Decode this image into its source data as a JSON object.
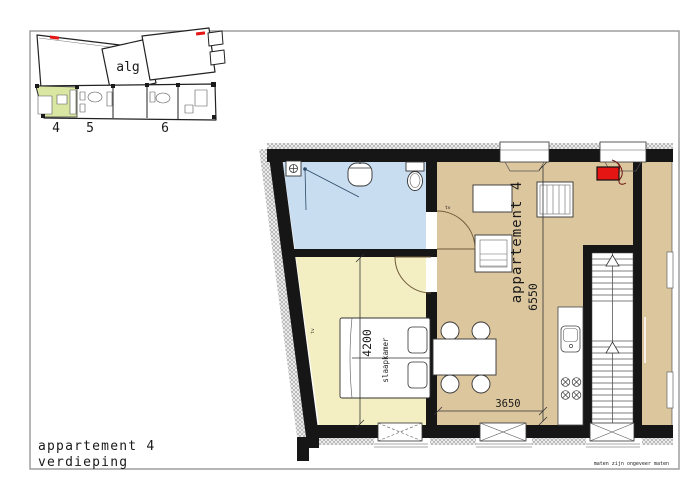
{
  "drawing": {
    "title_line1": "appartement 4",
    "title_line2": "verdieping",
    "disclaimer": "maten zijn ongeveer maten"
  },
  "overview": {
    "common_label": "alg",
    "apartments": [
      "4",
      "5",
      "6"
    ]
  },
  "plan": {
    "apartment_label": "appartement 4",
    "bedroom_label": "slaapkamer",
    "dim_living_depth": "6550",
    "dim_living_width": "3650",
    "dim_bedroom_depth": "4200",
    "tv_label_bedroom": "tv",
    "tv_label_living": "tv"
  },
  "colors": {
    "bathroom": "#c9ddf1",
    "bedroom": "#f3efc2",
    "living": "#dcc69e",
    "highlight_apartment": "#d9e7a3",
    "accent_red": "#e51513",
    "wall": "#161616"
  }
}
